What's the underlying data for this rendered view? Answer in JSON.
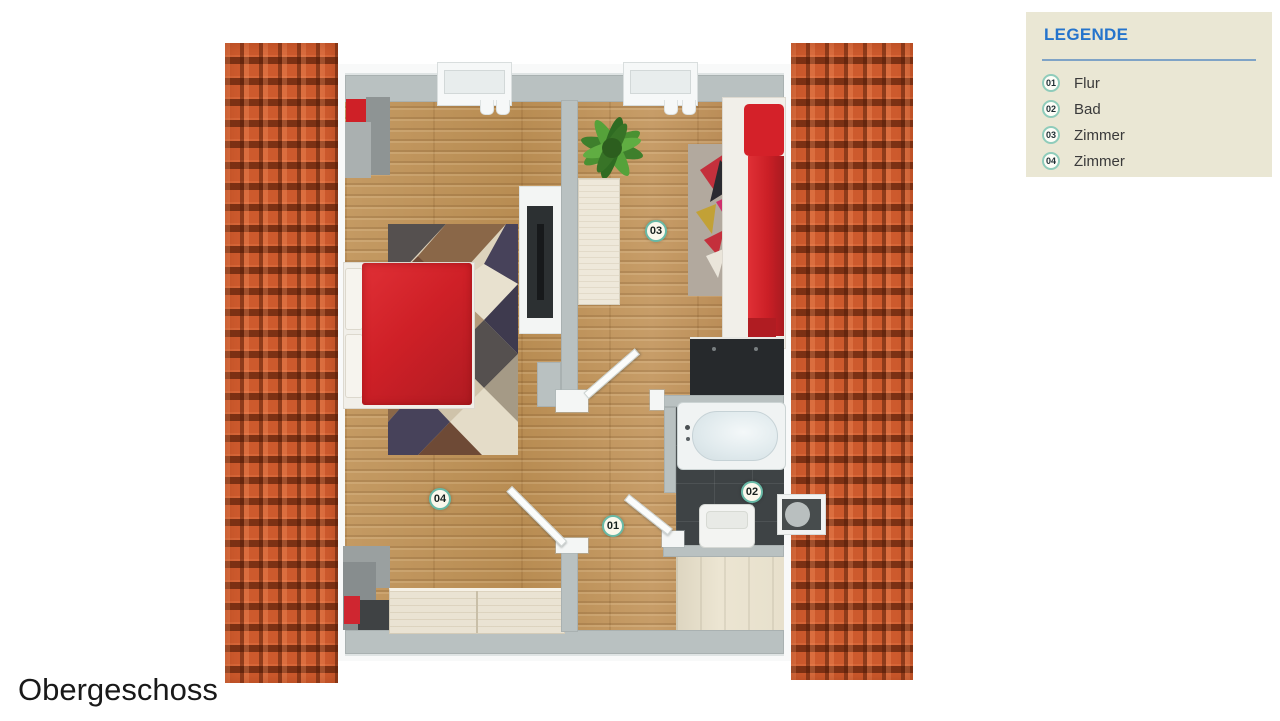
{
  "title": {
    "label": "Obergeschoss"
  },
  "legend": {
    "title": "LEGENDE",
    "items": [
      {
        "num": "01",
        "label": "Flur"
      },
      {
        "num": "02",
        "label": "Bad"
      },
      {
        "num": "03",
        "label": "Zimmer"
      },
      {
        "num": "04",
        "label": "Zimmer"
      }
    ]
  },
  "floorplan": {
    "markers": [
      {
        "num": "01"
      },
      {
        "num": "02"
      },
      {
        "num": "03"
      },
      {
        "num": "04"
      }
    ]
  },
  "colors": {
    "roof": "#cd5a2d",
    "wall": "#b9c1c1",
    "wood": "#c2945c",
    "legend_bg": "#eae7d4",
    "legend_title": "#2574cc",
    "badge_ring": "#68b9a6",
    "furniture_red": "#cf2027",
    "bath_tile": "#3e4345"
  }
}
